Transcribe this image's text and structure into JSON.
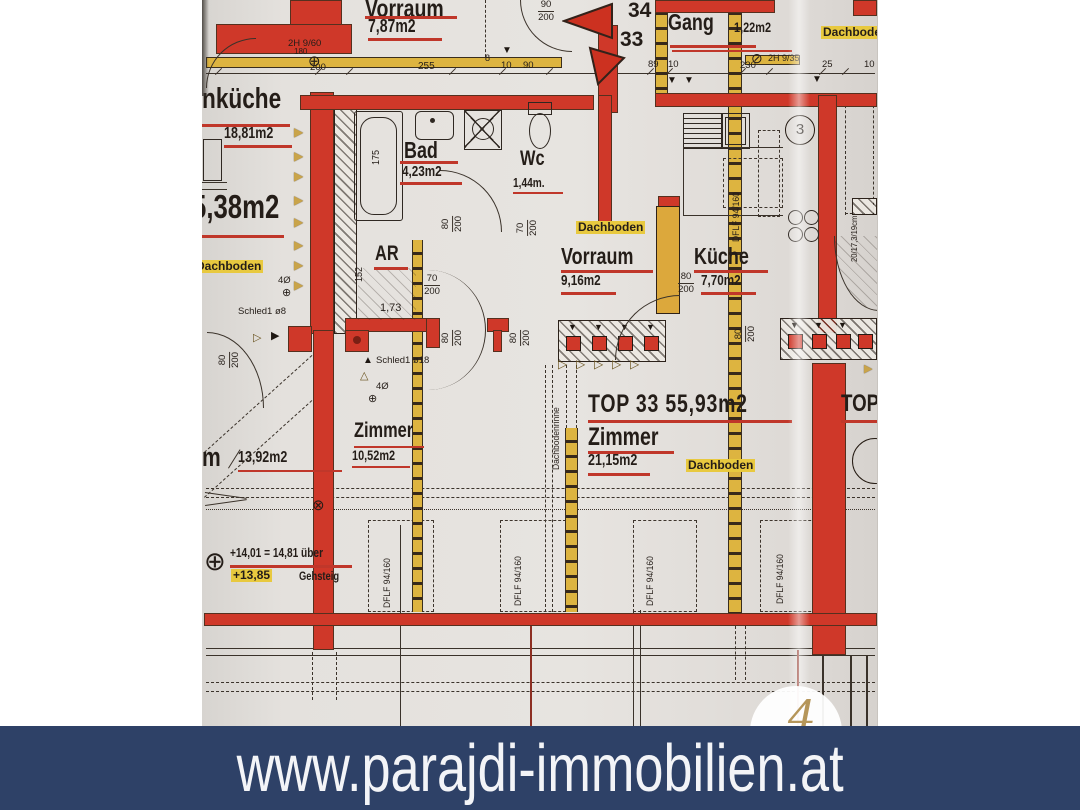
{
  "banner": {
    "url": "www.parajdi-immobilien.at"
  },
  "watermark": {
    "digit": "4"
  },
  "axis": {
    "n34": "34",
    "n33": "33",
    "bubble3": "3"
  },
  "rooms": {
    "vorraum_top": {
      "name": "Vorraum",
      "area": "7,87m2"
    },
    "gang": {
      "name": "Gang",
      "area": "1,22m2"
    },
    "wohnkueche": {
      "name": "nküche",
      "area": "18,81m2"
    },
    "anteroom": {
      "area": "5,38m2"
    },
    "bad": {
      "name": "Bad",
      "area": "4,23m2"
    },
    "wc": {
      "name": "Wc",
      "area": "1,44m."
    },
    "ar": {
      "name": "AR"
    },
    "vorraum": {
      "name": "Vorraum",
      "area": "9,16m2"
    },
    "kueche": {
      "name": "Küche",
      "area": "7,70m2"
    },
    "zimmer_klein": {
      "name": "Zimmer",
      "area": "10,52m2"
    },
    "zimmer_gross": {
      "name": "Zimmer",
      "area": "21,15m2"
    },
    "left_room": {
      "name": "m",
      "area": "13,92m2"
    },
    "top33": {
      "title": "TOP 33  55,93m2"
    },
    "top_next": {
      "title": "TOP"
    }
  },
  "labels": {
    "dachboden": "Dachboden",
    "dachbodenrinne": "Dachbodenrinne",
    "dflf": "DFLF 94/160",
    "schled8": "Schled1 ø8",
    "schled18": "Schled1 ø18",
    "level_text": "+14,01 = 14,81 über",
    "level_text2": "Gehsteig",
    "level_value": "+13,85",
    "stair_note": "20/17,3/19cm",
    "vier_o": "4Ø"
  },
  "dims": {
    "n2h960": "2H 9/60",
    "n180": "180",
    "n200": "200",
    "n255": "255",
    "n10": "10",
    "n90": "90",
    "n8": "8",
    "n89": "89",
    "n230": "230",
    "n2h935": "2H 9/35",
    "n25": "25",
    "n175": "175",
    "n152": "152",
    "n70": "70",
    "n80": "80",
    "n173": "1,73"
  },
  "icons": {
    "tri_right": "▶",
    "tri_right_open": "▷",
    "tri_up": "▲",
    "tri_up_open": "△",
    "tri_down": "▼",
    "circle_plus": "⊕",
    "circle_x": "⊗",
    "circle_slash": "⊘"
  },
  "colors": {
    "wall_red": "#cf3829",
    "timber_yellow": "#ddb440",
    "banner_bg": "#2e4167",
    "underline_red": "#c0372a",
    "highlight_yellow": "#e8c93f"
  }
}
